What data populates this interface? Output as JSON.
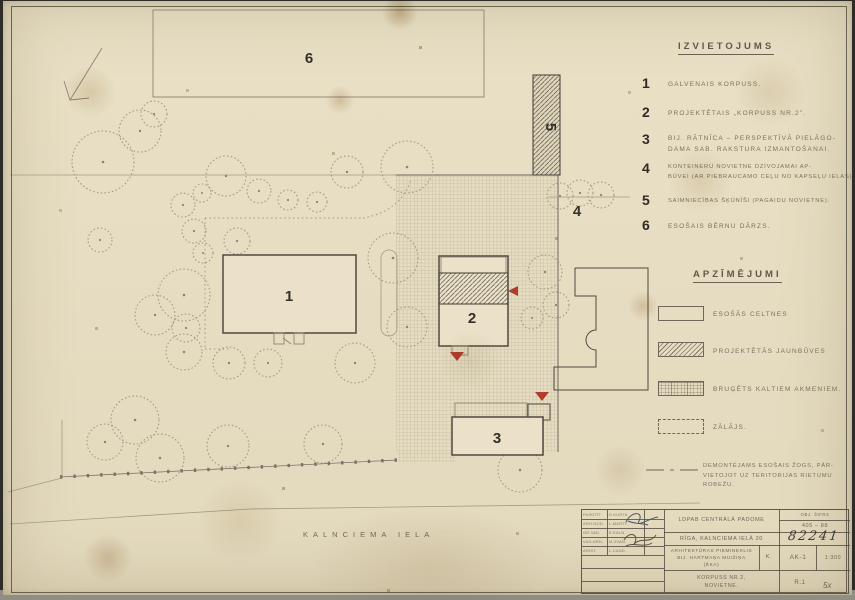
{
  "plan": {
    "street_label": "KALNCIEMA IELA",
    "labels": {
      "b1": "1",
      "b2": "2",
      "b3": "3",
      "b4": "4",
      "b5": "5",
      "b6": "6"
    }
  },
  "izvietojums": {
    "title": "IZVIETOJUMS",
    "items": [
      {
        "num": "1",
        "text": "GALVENAIS KORPUSS."
      },
      {
        "num": "2",
        "text": "PROJEKTĒTAIS „KORPUSS NR.2”."
      },
      {
        "num": "3",
        "text": "BIJ. RĀTNĪCA – PERSPEKTĪVĀ PIELĀGO-\nDAMA SAB. RAKSTURA IZMANTOŠANAI."
      },
      {
        "num": "4",
        "text": "KONTEINERU NOVIETNE DZĪVOJAMAI AP-\nBŪVEI (AR PIEBRAUCAMO CEĻU NO KAPSEĻU IELAS)"
      },
      {
        "num": "5",
        "text": "SAIMNIECĪBAS ŠĶŪNĪŠI (PAGAIDU NOVIETNE)."
      },
      {
        "num": "6",
        "text": "ESOŠAIS BĒRNU DĀRZS."
      }
    ]
  },
  "apzimejumi": {
    "title": "APZĪMĒJUMI",
    "items": [
      {
        "label": "ESOŠĀS CELTNES"
      },
      {
        "label": "PROJEKTĒTĀS JAUNBŪVES"
      },
      {
        "label": "BRUĢĒTS KALTIEM AKMENIEM."
      },
      {
        "label": "ZĀLĀJS."
      }
    ],
    "note": "DEMONTĒJAMS ESOŠAIS ŽOGS, PĀR-\nVIETOJOT UZ TERITORIJAS RIETUMU\nROBEŽU."
  },
  "titleblock": {
    "org": "LDPAB CENTRĀLĀ PADOME",
    "address": "RĪGA, KALNCIEMA IELĀ 20",
    "object": "ARHITEKTŪRAS PIEMINEKLIS\nBIJ. HARTMAŅA MUIŽIŅA\n(ĒKA)",
    "sheet_title": "KORPUSS NR.2,\nNOVIETNE.",
    "obj_code_label": "OBJ. ŠIFRS",
    "obj_code": "405 – 88",
    "inventory_no": "82241",
    "k_label": "K.",
    "stage": "AK-1",
    "scale": "1:300",
    "revision": "R.1",
    "pencil_note": "5x",
    "staff": [
      {
        "role": "PASŪTĪT.",
        "name": "D.KURTA"
      },
      {
        "role": "ARH.NOD.",
        "name": "L.MARTF."
      },
      {
        "role": "GR.VAD.",
        "name": "E.KALN."
      },
      {
        "role": "VAD.ARH.",
        "name": "M.ZVAN."
      },
      {
        "role": "ARHIT.",
        "name": "L.CAND."
      }
    ]
  }
}
